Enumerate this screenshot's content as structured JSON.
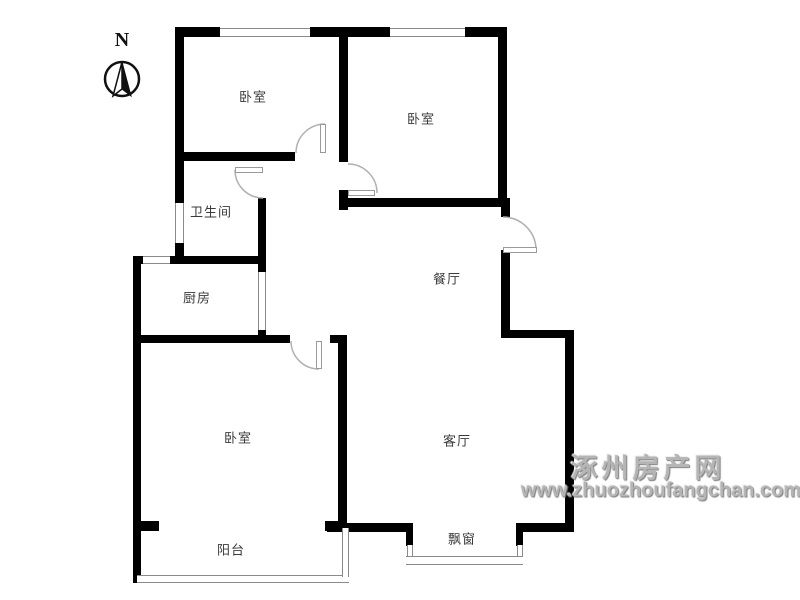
{
  "compass": {
    "north_label": "N"
  },
  "rooms": {
    "bedroom_top_left": "卧室",
    "bedroom_top_right": "卧室",
    "bathroom": "卫生间",
    "kitchen": "厨房",
    "dining_room": "餐厅",
    "living_room": "客厅",
    "bedroom_bottom": "卧室",
    "balcony": "阳台",
    "bay_window": "飘窗"
  },
  "watermark": {
    "site_name": "涿州房产网",
    "site_url": "www.zhuozhoufangchan.com"
  },
  "colors": {
    "wall": "#000000",
    "door_arc": "#b0b0b0",
    "window_line": "#8a8a8a",
    "label_text": "#3a3a3a",
    "watermark_gray": "#b5b5b5"
  }
}
